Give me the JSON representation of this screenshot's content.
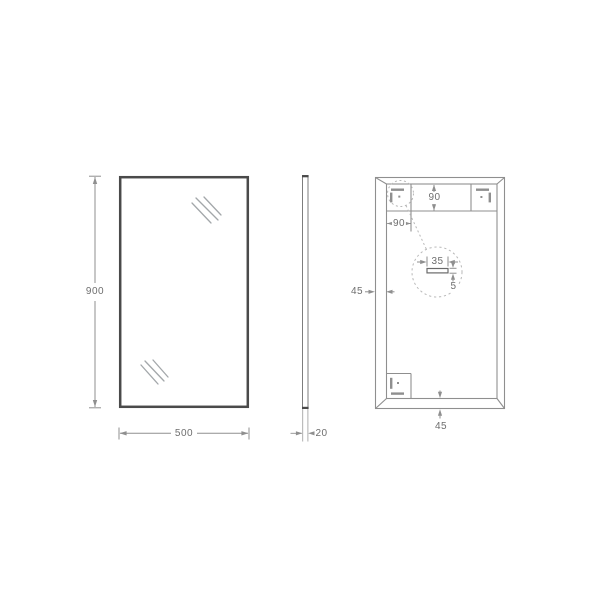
{
  "document": {
    "type": "technical-drawing",
    "subject": "mirror dimension spec sheet",
    "background": "#ffffff"
  },
  "views": {
    "front": {
      "name": "front view",
      "dim_height": "900",
      "dim_width": "500"
    },
    "side": {
      "name": "side view",
      "dim_thickness": "20"
    },
    "back": {
      "name": "back view",
      "dim_bracket_top_offset": "90",
      "dim_bracket_side_offset": "90",
      "dim_frame_side_width": "45",
      "dim_frame_bottom_width": "45",
      "dim_slot_width": "35",
      "dim_slot_height": "5"
    }
  },
  "icons": {
    "shine": "mirror-reflection-hatch",
    "bracket": "keyhole-mounting-bracket",
    "detail": "dashed-detail-callout-circle"
  },
  "colors": {
    "mirror_frame": "#4a4a4a",
    "drawing_line": "#8f8f8f",
    "dashed_line": "#b8b8b8",
    "dim_text": "#6e6e6e",
    "shine_line": "#a3a7aa"
  }
}
